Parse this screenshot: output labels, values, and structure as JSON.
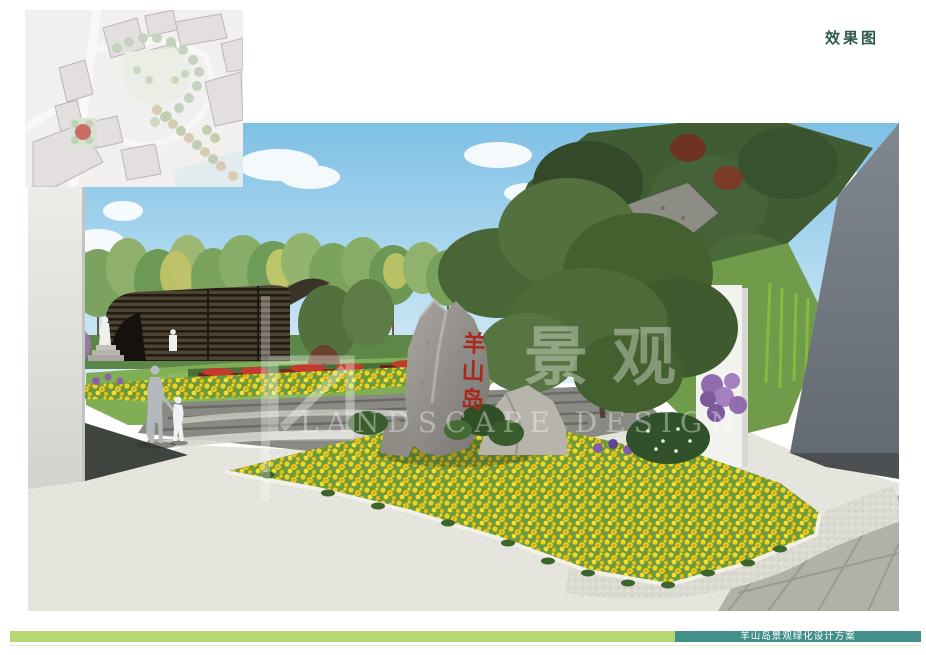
{
  "page": {
    "label": "效果图",
    "label_color": "#2f5a4e"
  },
  "inset_map": {
    "marker_color": "#b5342c"
  },
  "scene": {
    "rock_inscription": "羊山岛",
    "rock_inscription_color": "#a8291e",
    "watermark_cn": "景观",
    "watermark_en": "LANDSCAPE DESIGN",
    "sky_color": "#7ec0e5"
  },
  "footer": {
    "project_title": "羊山岛景观绿化设计方案",
    "bar_left_color": "#b7d774",
    "bar_right_color": "#43908a"
  }
}
